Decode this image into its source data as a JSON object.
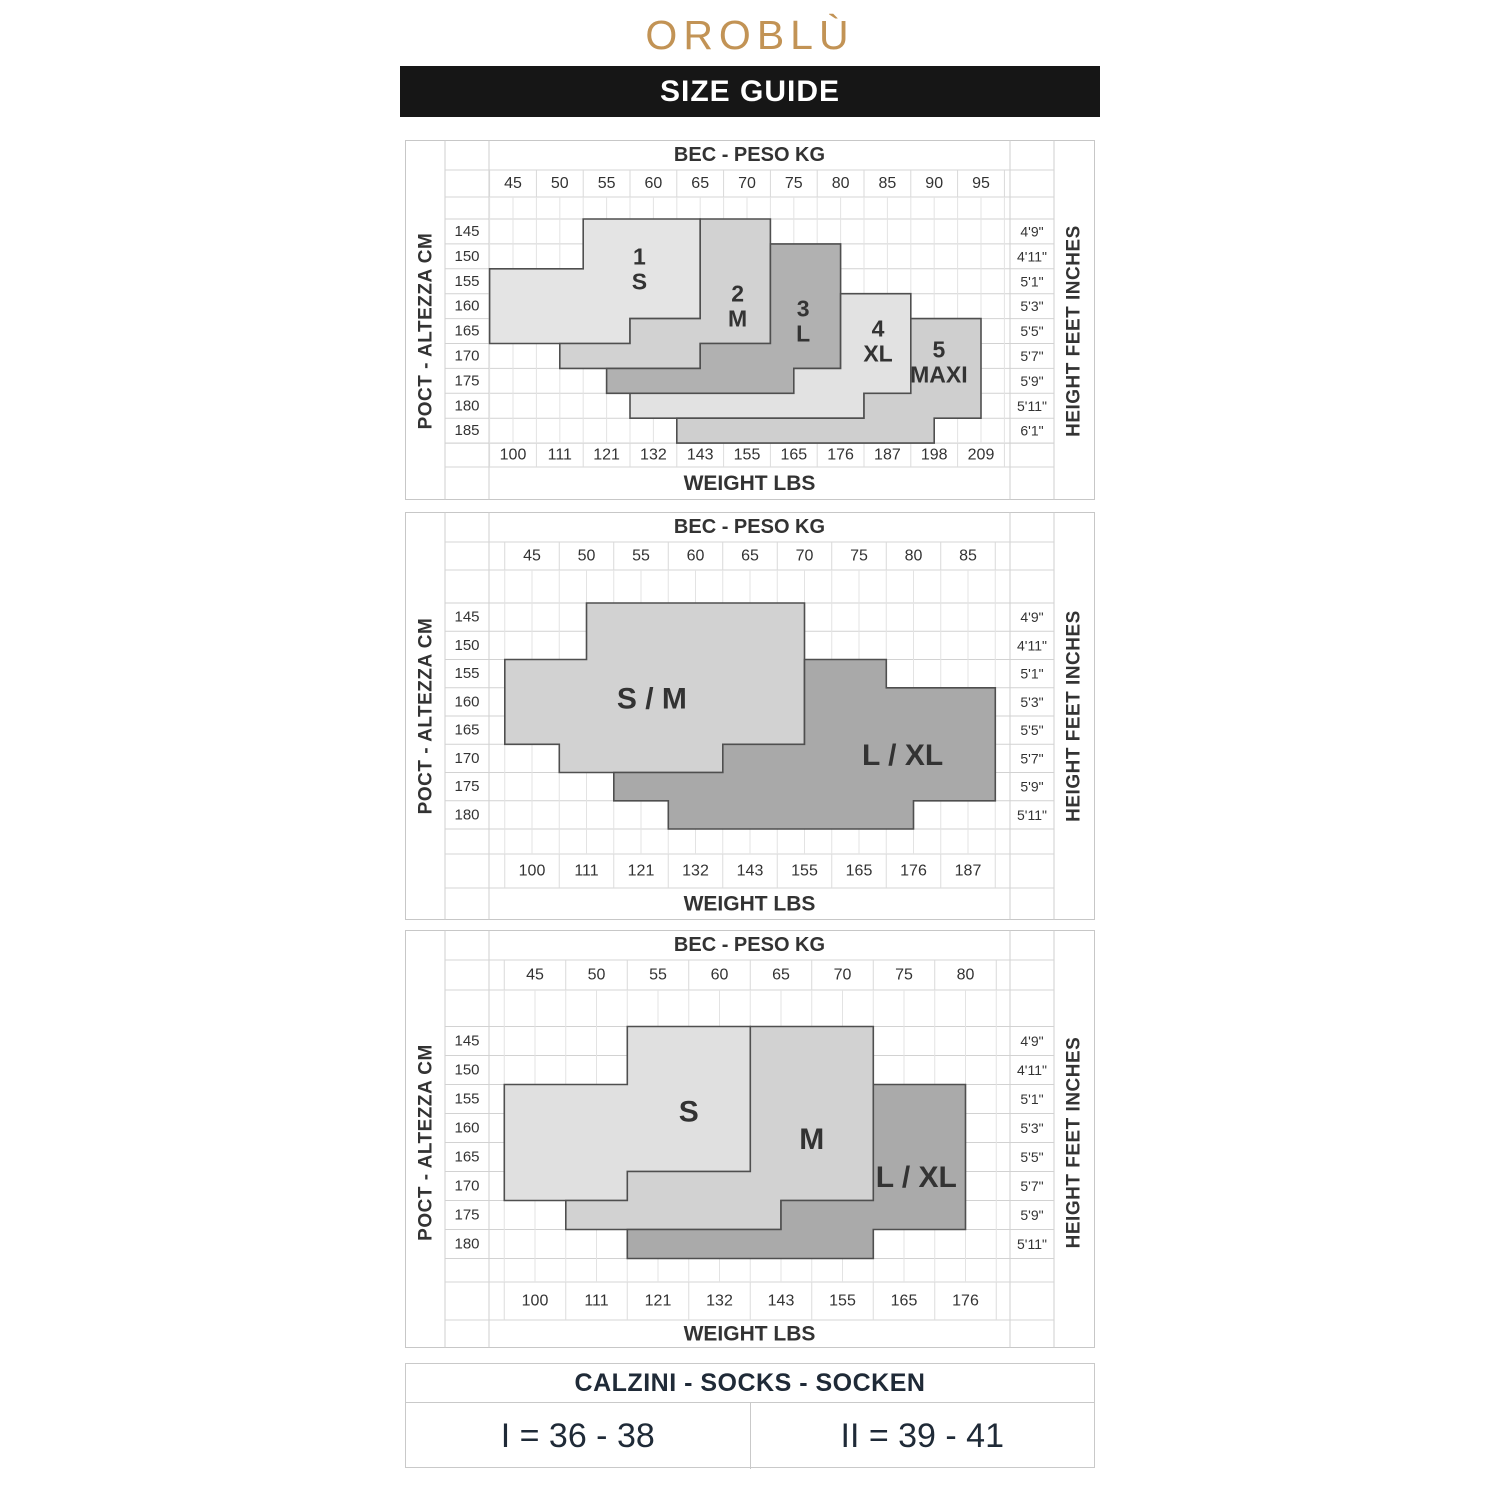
{
  "brand": {
    "logo": "OROBLÙ",
    "logo_color": "#c29355"
  },
  "banner": {
    "title": "SIZE GUIDE",
    "bg": "#161616",
    "fg": "#ffffff"
  },
  "chart_data": [
    {
      "type": "region-map",
      "title_top": "BEC - PESO KG",
      "title_bottom": "WEIGHT LBS",
      "axis_left": "POCT - ALTEZZA CM",
      "axis_right": "HEIGHT FEET INCHES",
      "kg": [
        45,
        50,
        55,
        60,
        65,
        70,
        75,
        80,
        85,
        90,
        95
      ],
      "cm": [
        145,
        150,
        155,
        160,
        165,
        170,
        175,
        180,
        185
      ],
      "lbs": [
        100,
        111,
        121,
        132,
        143,
        155,
        165,
        176,
        187,
        198,
        209
      ],
      "ft": [
        "4'9\"",
        "4'11\"",
        "5'1\"",
        "5'3\"",
        "5'5\"",
        "5'7\"",
        "5'9\"",
        "5'11\"",
        "6'1\""
      ],
      "layout": {
        "h": 360,
        "headerLine": 30,
        "kgLine": 57,
        "b0": 79,
        "rowH": 24.9,
        "nRows": 9,
        "lbsTop": 303.1,
        "lbsBot": 327,
        "kgX0": 108,
        "kgPx": 9.36,
        "kgMax": 95
      },
      "regions": [
        {
          "id": "1-s",
          "fill": "#e4e4e4",
          "label": {
            "lines": [
              "1",
              "S"
            ],
            "kg": 58.5,
            "row": 2.0
          },
          "poly": [
            [
              52.5,
              0
            ],
            [
              65,
              0
            ],
            [
              65,
              4
            ],
            [
              57.5,
              4
            ],
            [
              57.5,
              5
            ],
            [
              42.5,
              5
            ],
            [
              42.5,
              2
            ],
            [
              52.5,
              2
            ]
          ]
        },
        {
          "id": "2-m",
          "fill": "#d2d2d2",
          "label": {
            "lines": [
              "2",
              "M"
            ],
            "kg": 69,
            "row": 3.5
          },
          "poly": [
            [
              65,
              0
            ],
            [
              72.5,
              0
            ],
            [
              72.5,
              5
            ],
            [
              65,
              5
            ],
            [
              65,
              6
            ],
            [
              50,
              6
            ],
            [
              50,
              5
            ],
            [
              57.5,
              5
            ],
            [
              57.5,
              4
            ],
            [
              65,
              4
            ]
          ]
        },
        {
          "id": "3-l",
          "fill": "#b1b1b1",
          "label": {
            "lines": [
              "3",
              "L"
            ],
            "kg": 76,
            "row": 4.1
          },
          "poly": [
            [
              72.5,
              1
            ],
            [
              80,
              1
            ],
            [
              80,
              6
            ],
            [
              75,
              6
            ],
            [
              75,
              7
            ],
            [
              55,
              7
            ],
            [
              55,
              6
            ],
            [
              65,
              6
            ],
            [
              65,
              5
            ],
            [
              72.5,
              5
            ]
          ]
        },
        {
          "id": "4-xl",
          "fill": "#e2e2e2",
          "label": {
            "lines": [
              "4",
              "XL"
            ],
            "kg": 84,
            "row": 4.9
          },
          "poly": [
            [
              80,
              3
            ],
            [
              87.5,
              3
            ],
            [
              87.5,
              7
            ],
            [
              82.5,
              7
            ],
            [
              82.5,
              8
            ],
            [
              57.5,
              8
            ],
            [
              57.5,
              7
            ],
            [
              75,
              7
            ],
            [
              75,
              6
            ],
            [
              80,
              6
            ]
          ]
        },
        {
          "id": "5-maxi",
          "fill": "#cfcfcf",
          "label": {
            "lines": [
              "5",
              "MAXI"
            ],
            "kg": 90.5,
            "row": 5.75
          },
          "poly": [
            [
              87.5,
              4
            ],
            [
              95,
              4
            ],
            [
              95,
              8
            ],
            [
              90,
              8
            ],
            [
              90,
              9
            ],
            [
              62.5,
              9
            ],
            [
              62.5,
              8
            ],
            [
              82.5,
              8
            ],
            [
              82.5,
              7
            ],
            [
              87.5,
              7
            ]
          ]
        }
      ]
    },
    {
      "type": "region-map",
      "title_top": "BEC - PESO KG",
      "title_bottom": "WEIGHT LBS",
      "axis_left": "POCT - ALTEZZA CM",
      "axis_right": "HEIGHT FEET INCHES",
      "kg": [
        45,
        50,
        55,
        60,
        65,
        70,
        75,
        80,
        85
      ],
      "cm": [
        145,
        150,
        155,
        160,
        165,
        170,
        175,
        180
      ],
      "lbs": [
        100,
        111,
        121,
        132,
        143,
        155,
        165,
        176,
        187
      ],
      "ft": [
        "4'9\"",
        "4'11\"",
        "5'1\"",
        "5'3\"",
        "5'5\"",
        "5'7\"",
        "5'9\"",
        "5'11\""
      ],
      "layout": {
        "h": 408,
        "headerLine": 30,
        "kgLine": 58,
        "b0": 91,
        "rowH": 28.25,
        "nRows": 8,
        "lbsTop": 342,
        "lbsBot": 376,
        "kgX0": 127,
        "kgPx": 10.9,
        "kgMax": 85
      },
      "regions": [
        {
          "id": "s-m",
          "fill": "#d2d2d2",
          "label": {
            "lines": [
              "S / M"
            ],
            "kg": 56,
            "row": 3.4
          },
          "poly": [
            [
              50,
              0
            ],
            [
              70,
              0
            ],
            [
              70,
              5
            ],
            [
              62.5,
              5
            ],
            [
              62.5,
              6
            ],
            [
              47.5,
              6
            ],
            [
              47.5,
              5
            ],
            [
              42.5,
              5
            ],
            [
              42.5,
              2
            ],
            [
              50,
              2
            ]
          ]
        },
        {
          "id": "l-xl",
          "fill": "#a9a9a9",
          "label": {
            "lines": [
              "L / XL"
            ],
            "kg": 79,
            "row": 5.4
          },
          "poly": [
            [
              70,
              2
            ],
            [
              77.5,
              2
            ],
            [
              77.5,
              3
            ],
            [
              87.5,
              3
            ],
            [
              87.5,
              7
            ],
            [
              80,
              7
            ],
            [
              80,
              8
            ],
            [
              57.5,
              8
            ],
            [
              57.5,
              7
            ],
            [
              52.5,
              7
            ],
            [
              52.5,
              6
            ],
            [
              62.5,
              6
            ],
            [
              62.5,
              5
            ],
            [
              70,
              5
            ]
          ]
        }
      ]
    },
    {
      "type": "region-map",
      "title_top": "BEC - PESO KG",
      "title_bottom": "WEIGHT LBS",
      "axis_left": "POCT - ALTEZZA CM",
      "axis_right": "HEIGHT FEET INCHES",
      "kg": [
        45,
        50,
        55,
        60,
        65,
        70,
        75,
        80
      ],
      "cm": [
        145,
        150,
        155,
        160,
        165,
        170,
        175,
        180
      ],
      "lbs": [
        100,
        111,
        121,
        132,
        143,
        155,
        165,
        176
      ],
      "ft": [
        "4'9\"",
        "4'11\"",
        "5'1\"",
        "5'3\"",
        "5'5\"",
        "5'7\"",
        "5'9\"",
        "5'11\""
      ],
      "layout": {
        "h": 418,
        "headerLine": 30,
        "kgLine": 60,
        "b0": 96.5,
        "rowH": 29,
        "nRows": 8,
        "lbsTop": 352,
        "lbsBot": 390,
        "kgX0": 130,
        "kgPx": 12.3,
        "kgMax": 80
      },
      "regions": [
        {
          "id": "s",
          "fill": "#e0e0e0",
          "label": {
            "lines": [
              "S"
            ],
            "kg": 57.5,
            "row": 2.95
          },
          "poly": [
            [
              52.5,
              0
            ],
            [
              62.5,
              0
            ],
            [
              62.5,
              5
            ],
            [
              52.5,
              5
            ],
            [
              52.5,
              6
            ],
            [
              42.5,
              6
            ],
            [
              42.5,
              2
            ],
            [
              52.5,
              2
            ]
          ]
        },
        {
          "id": "m",
          "fill": "#d2d2d2",
          "label": {
            "lines": [
              "M"
            ],
            "kg": 67.5,
            "row": 3.9
          },
          "poly": [
            [
              62.5,
              0
            ],
            [
              72.5,
              0
            ],
            [
              72.5,
              6
            ],
            [
              65,
              6
            ],
            [
              65,
              7
            ],
            [
              47.5,
              7
            ],
            [
              47.5,
              6
            ],
            [
              52.5,
              6
            ],
            [
              52.5,
              5
            ],
            [
              62.5,
              5
            ]
          ]
        },
        {
          "id": "l-xl",
          "fill": "#aaaaaa",
          "label": {
            "lines": [
              "L / XL"
            ],
            "kg": 76,
            "row": 5.2
          },
          "poly": [
            [
              72.5,
              2
            ],
            [
              80,
              2
            ],
            [
              80,
              7
            ],
            [
              72.5,
              7
            ],
            [
              72.5,
              8
            ],
            [
              52.5,
              8
            ],
            [
              52.5,
              7
            ],
            [
              65,
              7
            ],
            [
              65,
              6
            ],
            [
              72.5,
              6
            ]
          ]
        }
      ]
    }
  ],
  "socks": {
    "header": "CALZINI - SOCKS - SOCKEN",
    "cells": [
      "I = 36 - 38",
      "II = 39 - 41"
    ]
  }
}
